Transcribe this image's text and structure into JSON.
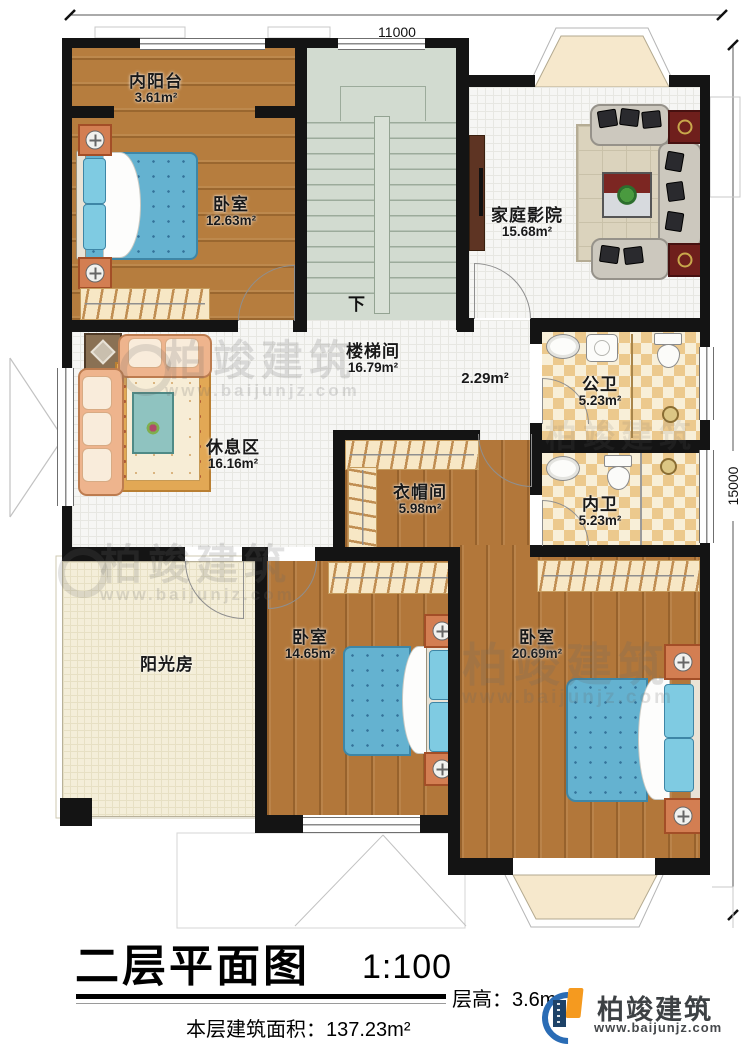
{
  "dimensions": {
    "top": "11000",
    "right": "15000"
  },
  "rooms": {
    "neiyangtai": {
      "name": "内阳台",
      "area": "3.61m²"
    },
    "bedroom1": {
      "name": "卧室",
      "area": "12.63m²"
    },
    "stairwell": {
      "name": "楼梯间",
      "area": "16.79m²"
    },
    "home_theater": {
      "name": "家庭影院",
      "area": "15.68m²"
    },
    "rest_area": {
      "name": "休息区",
      "area": "16.16m²"
    },
    "landing": {
      "area": "2.29m²"
    },
    "public_bath": {
      "name": "公卫",
      "area": "5.23m²"
    },
    "cloakroom": {
      "name": "衣帽间",
      "area": "5.98m²"
    },
    "private_bath": {
      "name": "内卫",
      "area": "5.23m²"
    },
    "sunroom": {
      "name": "阳光房"
    },
    "bedroom2": {
      "name": "卧室",
      "area": "14.65m²"
    },
    "bedroom3": {
      "name": "卧室",
      "area": "20.69m²"
    }
  },
  "stair": {
    "down_label": "下"
  },
  "title": {
    "main": "二层平面图",
    "scale": "1:100",
    "floor_height": "层高：3.6m",
    "floor_area": "本层建筑面积：137.23m²"
  },
  "logo": {
    "name": "柏竣建筑",
    "url": "www.baijunjz.com"
  },
  "watermark": {
    "name": "柏竣建筑",
    "url": "www.baijunjz.com"
  },
  "colors": {
    "wall": "#141414",
    "wood": "#b2773a",
    "bed": "#64b2d0",
    "checker": "#ecc98d",
    "stairs": "#d2dbd0",
    "logo_blue": "#2a6cb5",
    "logo_orange": "#f59a1f"
  }
}
